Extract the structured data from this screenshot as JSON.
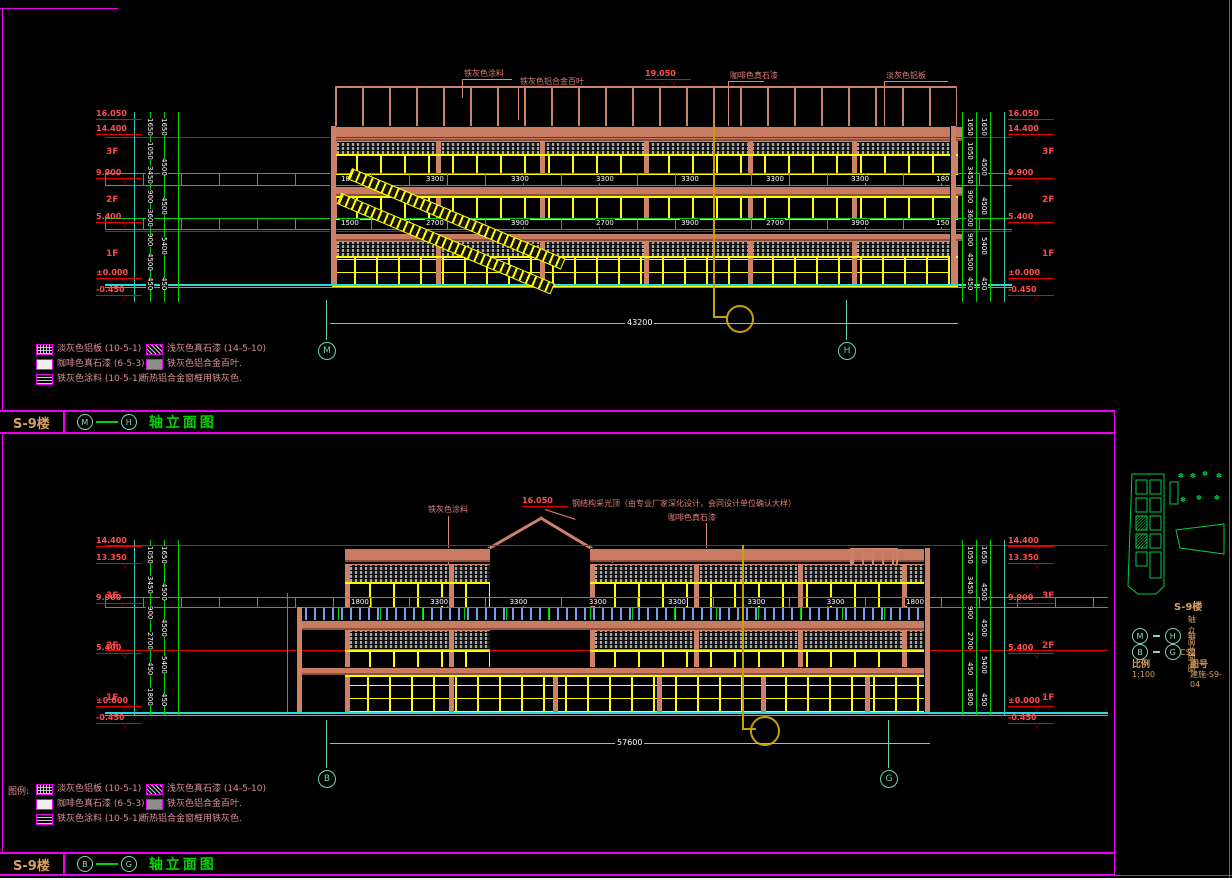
{
  "colors": {
    "magenta": "#f000f0",
    "salmon": "#cd8166",
    "yellow": "#ffff00",
    "red": "#e60000",
    "green": "#00d400",
    "cyan": "#26dcdc",
    "aqua": "#66d9a8",
    "white": "#ffffff",
    "panel_gray": "#a8a8a8",
    "post_blue": "#7b9cf0",
    "gold": "#c8a000",
    "orange_text": "#d8a060",
    "legend_text": "#d89090"
  },
  "legend": {
    "prefix": "图例:",
    "items": [
      {
        "swatch": "grid",
        "label": "淡灰色铝板 (10-5-1)",
        "x": 36,
        "y": 0
      },
      {
        "swatch": "diag",
        "label": "浅灰色真石漆 (14-5-10)",
        "x": 146,
        "y": 0
      },
      {
        "swatch": "empty",
        "label": "咖啡色真石漆 (6-5-3)",
        "x": 36,
        "y": 15
      },
      {
        "swatch": "solid",
        "label": "铁灰色铝合金百叶.",
        "x": 146,
        "y": 15
      },
      {
        "swatch": "dash",
        "label": "铁灰色涂料 (10-5-1)",
        "x": 36,
        "y": 30
      },
      {
        "swatch": "none",
        "label": "断热铝合金窗框用铁灰色.",
        "x": 140,
        "y": 30
      }
    ]
  },
  "titlebar_top": {
    "project": "S-9楼",
    "axis_from": "M",
    "axis_to": "H",
    "title": "轴立面图"
  },
  "titlebar_bottom": {
    "project": "S-9楼",
    "axis_from": "B",
    "axis_to": "G",
    "title": "轴立面图"
  },
  "elevation_top": {
    "annotations": [
      {
        "text": "铁灰色涂料",
        "x": 464,
        "y": 69
      },
      {
        "text": "铁灰色铝合金百叶",
        "x": 520,
        "y": 77
      },
      {
        "text": "咖啡色真石漆",
        "x": 730,
        "y": 71
      },
      {
        "text": "淡灰色铝板",
        "x": 886,
        "y": 71
      }
    ],
    "top_level": {
      "v": "19.050",
      "x": 645,
      "y": 70
    },
    "markers": [
      {
        "v": "16.050",
        "y": 110
      },
      {
        "v": "14.400",
        "y": 125
      },
      {
        "v": "9.900",
        "y": 169
      },
      {
        "v": "5.400",
        "y": 213
      },
      {
        "v": "±0.000",
        "y": 269
      },
      {
        "v": "-0.450",
        "y": 286
      }
    ],
    "floors": [
      {
        "t": "3F",
        "y": 148
      },
      {
        "t": "2F",
        "y": 196
      },
      {
        "t": "1F",
        "y": 250
      }
    ],
    "vdims_fine": [
      "1650",
      "1050",
      "3450",
      "900",
      "3600",
      "900",
      "4500",
      "450"
    ],
    "vdims_coarse": [
      "1650",
      "4500",
      "4500",
      "5400",
      "450"
    ],
    "hdims_1": [
      "1800",
      "3300",
      "3300",
      "3300",
      "3300",
      "3300",
      "3300",
      "1800"
    ],
    "hdims_2": [
      "1500",
      "2700",
      "3900",
      "2700",
      "3900",
      "2700",
      "3900",
      "1500"
    ],
    "overall": "43200",
    "axis_left": "M",
    "axis_right": "H"
  },
  "elevation_bottom": {
    "annotations": [
      {
        "text": "铁灰色涂料",
        "x": 428,
        "y": 505
      },
      {
        "text": "咖啡色真石漆",
        "x": 668,
        "y": 513
      }
    ],
    "roof_note": {
      "text": "钢结构采光顶（由专业厂家深化设计，会同设计单位确认大样）",
      "x": 572,
      "y": 499
    },
    "peak_level": {
      "v": "16.050",
      "x": 522,
      "y": 497
    },
    "markers": [
      {
        "v": "14.400",
        "y": 537
      },
      {
        "v": "13.350",
        "y": 554
      },
      {
        "v": "9.900",
        "y": 594
      },
      {
        "v": "5.400",
        "y": 644
      },
      {
        "v": "±0.000",
        "y": 697
      },
      {
        "v": "-0.450",
        "y": 714
      }
    ],
    "floors": [
      {
        "t": "3F",
        "y": 592
      },
      {
        "t": "2F",
        "y": 642
      },
      {
        "t": "1F",
        "y": 694
      }
    ],
    "vdims_fine": [
      "1050",
      "3450",
      "900",
      "2700",
      "450",
      "1800"
    ],
    "vdims_coarse": [
      "1650",
      "4500",
      "4500",
      "5400",
      "450"
    ],
    "hdims": [
      "1800",
      "3300",
      "3300",
      "3300",
      "3300",
      "3300",
      "3300",
      "1800"
    ],
    "overall": "57600",
    "axis_left": "B",
    "axis_right": "G"
  },
  "titleblock": {
    "name": "S-9楼",
    "rows": [
      {
        "from": "M",
        "to": "H",
        "label": "轴立面图",
        "y": 16
      },
      {
        "from": "B",
        "to": "G",
        "label": "轴立面图",
        "y": 32
      }
    ],
    "code": "CS2",
    "scale_label": "比例",
    "scale": "1:100",
    "sheet_label": "图号",
    "sheet_no": "建施-S9-04"
  }
}
